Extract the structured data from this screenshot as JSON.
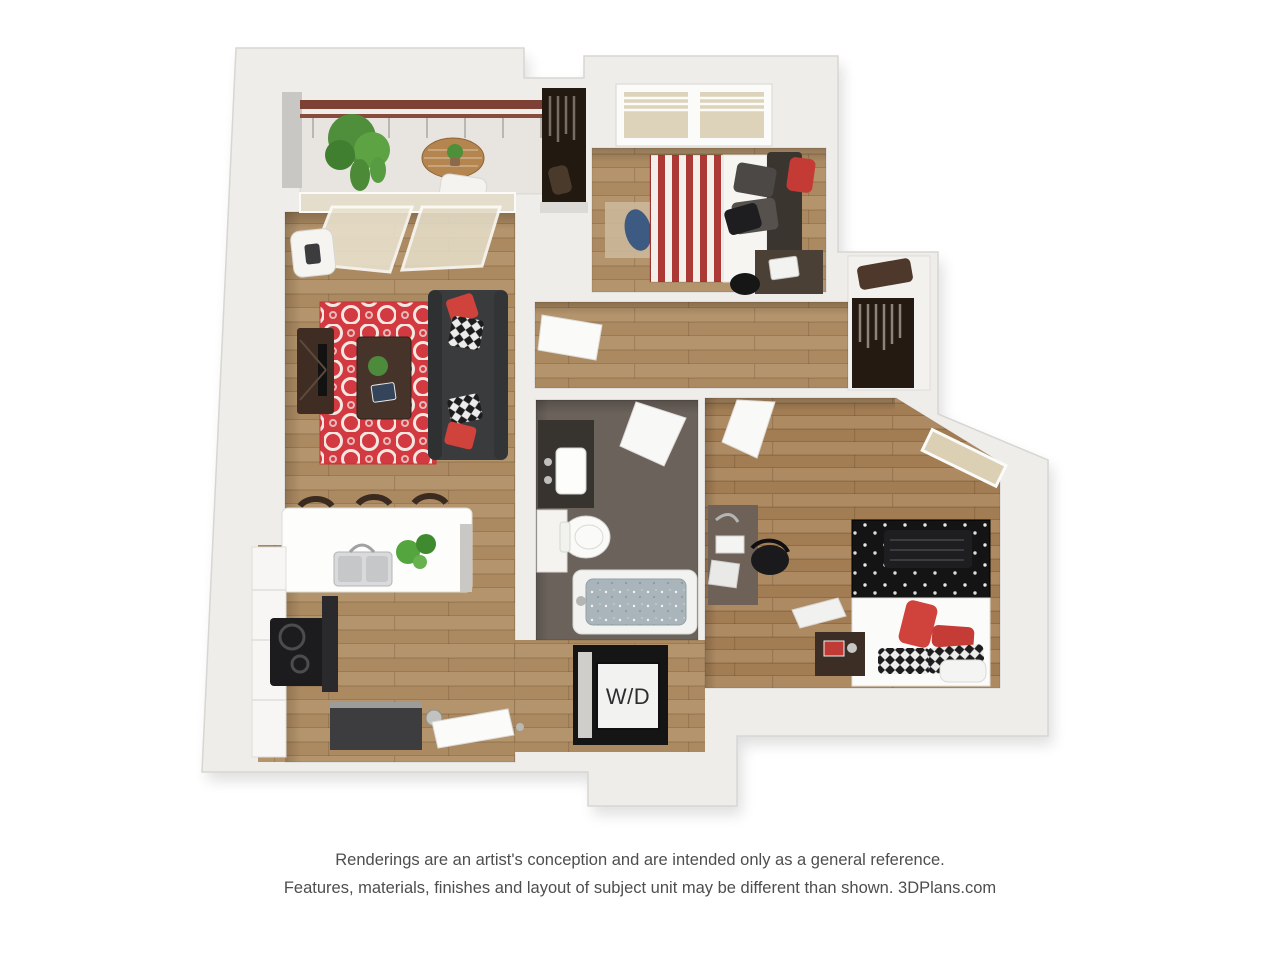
{
  "page": {
    "background_color": "#ffffff"
  },
  "floorplan": {
    "labels": {
      "washer_dryer": "W/D"
    },
    "rooms": [
      "balcony",
      "living-room",
      "kitchen",
      "hallway",
      "bedroom-1",
      "closet-1",
      "walk-in-closet",
      "bathroom",
      "laundry-closet",
      "bedroom-2",
      "entry"
    ],
    "palette": {
      "wall": "#efedea",
      "wood_floor": "#ab8a61",
      "accent_red": "#d23940",
      "sofa_charcoal": "#3a3b3d",
      "bed_stripe_red": "#ad3936",
      "bed2_black": "#141414",
      "bathroom_tile": "#6b625b",
      "plant_green": "#55a53f",
      "railing_brown": "#7c4134"
    }
  },
  "disclaimer": {
    "line1": "Renderings are an artist's conception and are intended only as a general reference.",
    "line2": "Features, materials, finishes and layout of subject unit may be different than shown. 3DPlans.com"
  }
}
